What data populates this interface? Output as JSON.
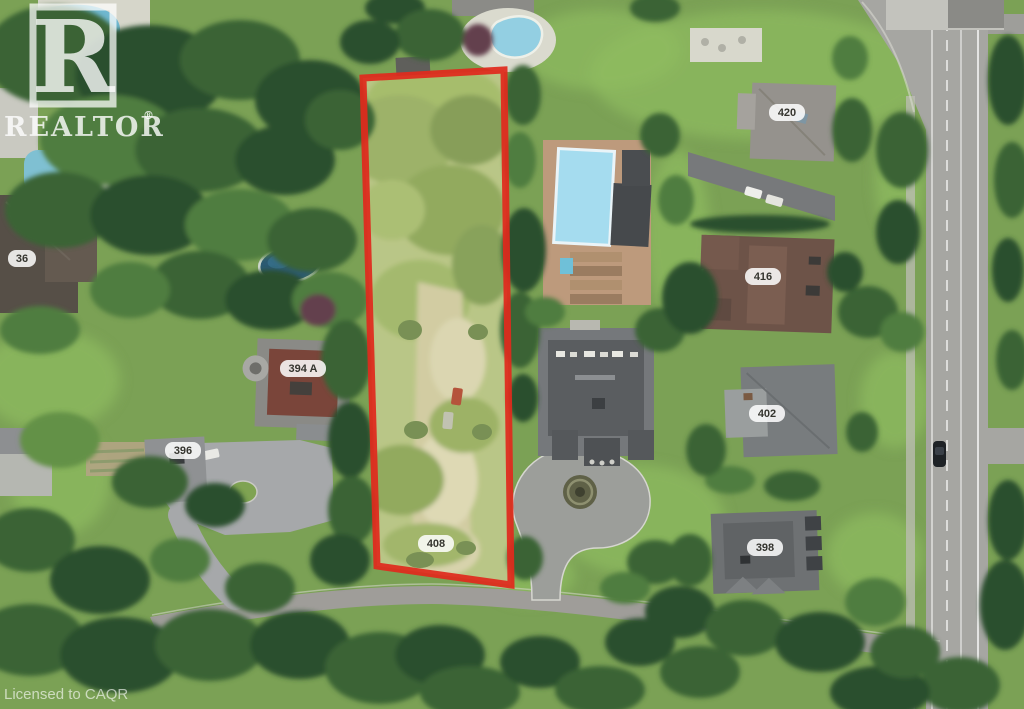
{
  "image_type": "aerial-real-estate-photo",
  "watermark": {
    "logo_letter": "R",
    "brand": "REALTOR",
    "registered": "®",
    "license": "Licensed to CAQR"
  },
  "labels": {
    "h36": "36",
    "h394a": "394 A",
    "h396": "396",
    "h398": "398",
    "h402": "402",
    "h408": "408",
    "h416": "416",
    "h420": "420"
  },
  "property": {
    "outline_color": "#e02a1d"
  },
  "colors": {
    "lawn": "#7ba155",
    "tree_dark": "#2c4f2d",
    "road": "#a6a6a2",
    "pool_light": "#a5dcef",
    "pool_dark": "#2b5a72",
    "deck_tan": "#bd9a7c",
    "red_car": "#a83024",
    "lot_highlight": "#f5f5a8"
  }
}
